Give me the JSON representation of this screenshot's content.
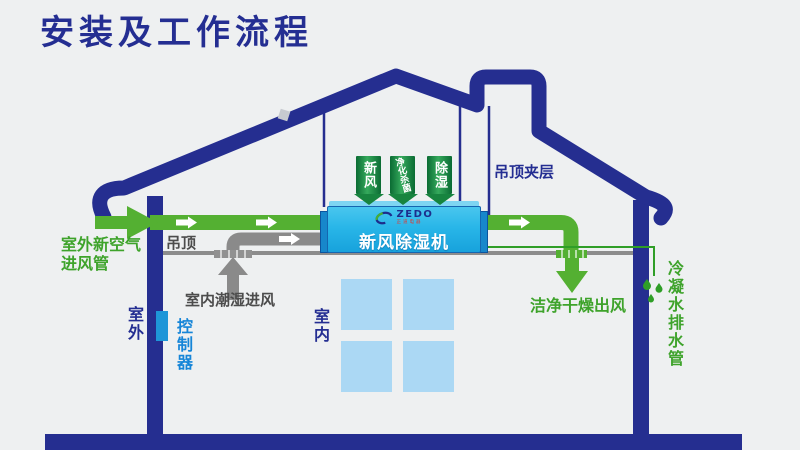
{
  "title": "安装及工作流程",
  "unit": {
    "brand": "ZEDO",
    "brand_tagline": "正道电器",
    "name": "新风除湿机"
  },
  "badges": [
    {
      "label": "新风"
    },
    {
      "label": "净化杀菌"
    },
    {
      "label": "除湿"
    }
  ],
  "labels": {
    "outdoor_fresh_air_line1": "室外新空气",
    "outdoor_fresh_air_line2": "进风管",
    "ceiling": "吊顶",
    "indoor_humid_intake": "室内潮湿进风",
    "ceiling_interlayer": "吊顶夹层",
    "clean_dry_outlet": "洁净干燥出风",
    "condensate_drain_pipe": "冷凝水排水管",
    "outdoor": "室外",
    "controller": "控制器",
    "indoor": "室内"
  },
  "colors": {
    "background": "#eef0f1",
    "navy": "#242e92",
    "label_green": "#3ea32b",
    "duct_green": "#54b032",
    "badge_green_dark": "#0a6b33",
    "badge_green_light": "#35a95c",
    "unit_cyan": "#29b6e8",
    "gray_duct": "#8a8a8a",
    "label_gray": "#4c4c4c",
    "controller_blue": "#1e96d8",
    "window_blue": "#abd8f4",
    "brand_red": "#e8332a"
  }
}
